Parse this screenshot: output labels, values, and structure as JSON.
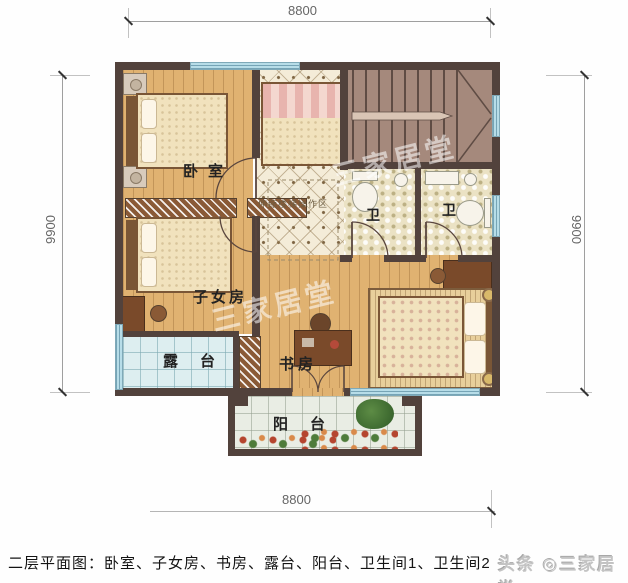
{
  "caption": "二层平面图：卧室、子女房、书房、露台、阳台、卫生间1、卫生间2",
  "branding": "头条 ◎三家居堂",
  "dims": {
    "top": "8800",
    "bottom": "8800",
    "left": "9900",
    "right": "9900"
  },
  "rooms": {
    "bedroom": {
      "label": "卧室"
    },
    "children": {
      "label": "子女房"
    },
    "study": {
      "label": "书房"
    },
    "terrace": {
      "label": "露台"
    },
    "balcony": {
      "label": "阳台"
    },
    "bath1": {
      "label": "卫"
    },
    "bath2": {
      "label": "卫"
    },
    "stair_note": "伸缩楼梯操作区"
  },
  "watermark_faint": "三家居堂",
  "colors": {
    "wall": "#52423c",
    "window": "#b7dde8",
    "wood_floor": "#e0b271",
    "hall_tile": "#f4ecd8",
    "bath_tile": "#ebe2c4",
    "terrace_tile": "#ddeef0",
    "balcony_tile": "#e9ede4",
    "stairs": "#a5897c"
  }
}
